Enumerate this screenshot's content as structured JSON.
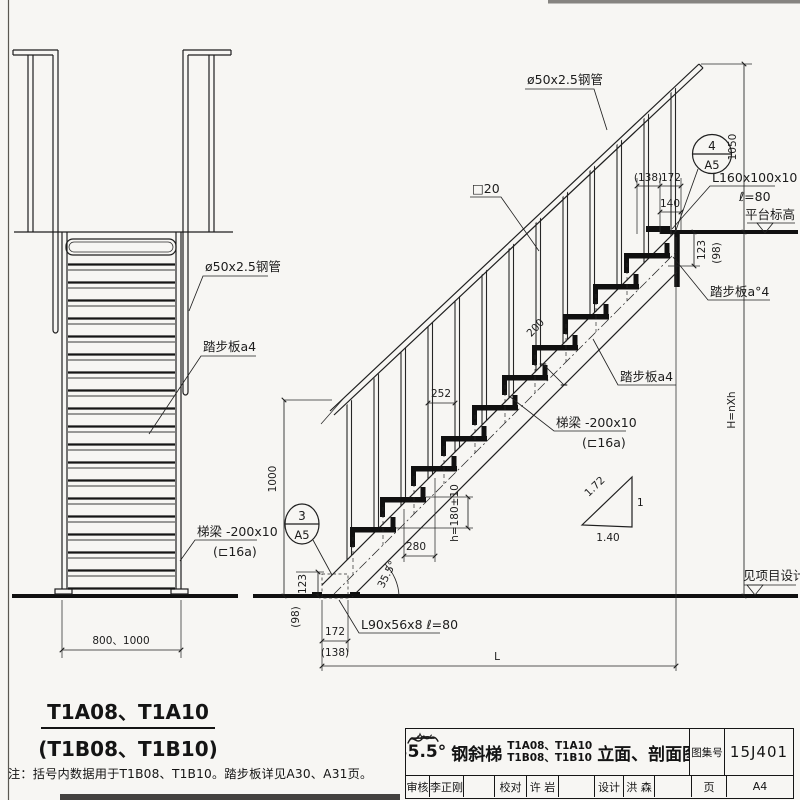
{
  "palette": {
    "ink": "#1c1c1c",
    "paper": "#f7f6f3"
  },
  "left_view": {
    "label_pipe": "ø50x2.5钢管",
    "label_tread": "踏步板a4",
    "label_stringer_1": "梯梁 -200x10",
    "label_stringer_2": "(⊏16a)",
    "dim_width": "800、1000",
    "caption_1": "T1A08、T1A10",
    "caption_2": "(T1B08、T1B10)"
  },
  "right_view": {
    "label_pipe": "ø50x2.5钢管",
    "label_square_bar": "□20",
    "dim_138_top": "(138)",
    "dim_172_top": "172",
    "dim_140": "140",
    "detail_top_num": "4",
    "detail_top_page": "A5",
    "dim_1050": "1050",
    "label_angle_cleat_1": "L160x100x10",
    "label_angle_cleat_2": "ℓ=80",
    "label_platform_level": "平台标高",
    "dim_123_right": "123",
    "dim_98_right": "(98)",
    "label_tread_upper": "踏步板a°4",
    "label_tread_lower": "踏步板a4",
    "label_stringer_1": "梯梁 -200x10",
    "label_stringer_2": "(⊏16a)",
    "dim_252": "252",
    "dim_280": "280",
    "dim_rise": "h=180±10",
    "dim_200": "200",
    "dim_angle": "35.5°",
    "dim_123_left": "123",
    "dim_98_left": "(98)",
    "dim_172_bottom": "172",
    "dim_138_bottom": "(138)",
    "label_base_cleat": "L90x56x8  ℓ=80",
    "dim_length": "L",
    "dim_height": "H=nXh",
    "detail_bottom_num": "3",
    "detail_bottom_page": "A5",
    "slope_hyp": "1.72",
    "slope_run": "1.40",
    "slope_rise": "1",
    "label_see_project": "见项目设计"
  },
  "note": "注：括号内数据用于T1B08、T1B10。踏步板详见A30、A31页。",
  "title_block": {
    "angle": "35.5°",
    "name": "钢斜梯",
    "models_1": "T1A08、T1A10",
    "models_2": "T1B08、T1B10",
    "suffix": "立面、剖面图",
    "atlas_label": "图集号",
    "atlas_no": "15J401",
    "row": [
      {
        "label": "审核",
        "value": "李正刚"
      },
      {
        "label": "校对",
        "value": "许 岩"
      },
      {
        "label": "设计",
        "value": "洪 森"
      }
    ],
    "page_label": "页",
    "page_no": "A4"
  }
}
